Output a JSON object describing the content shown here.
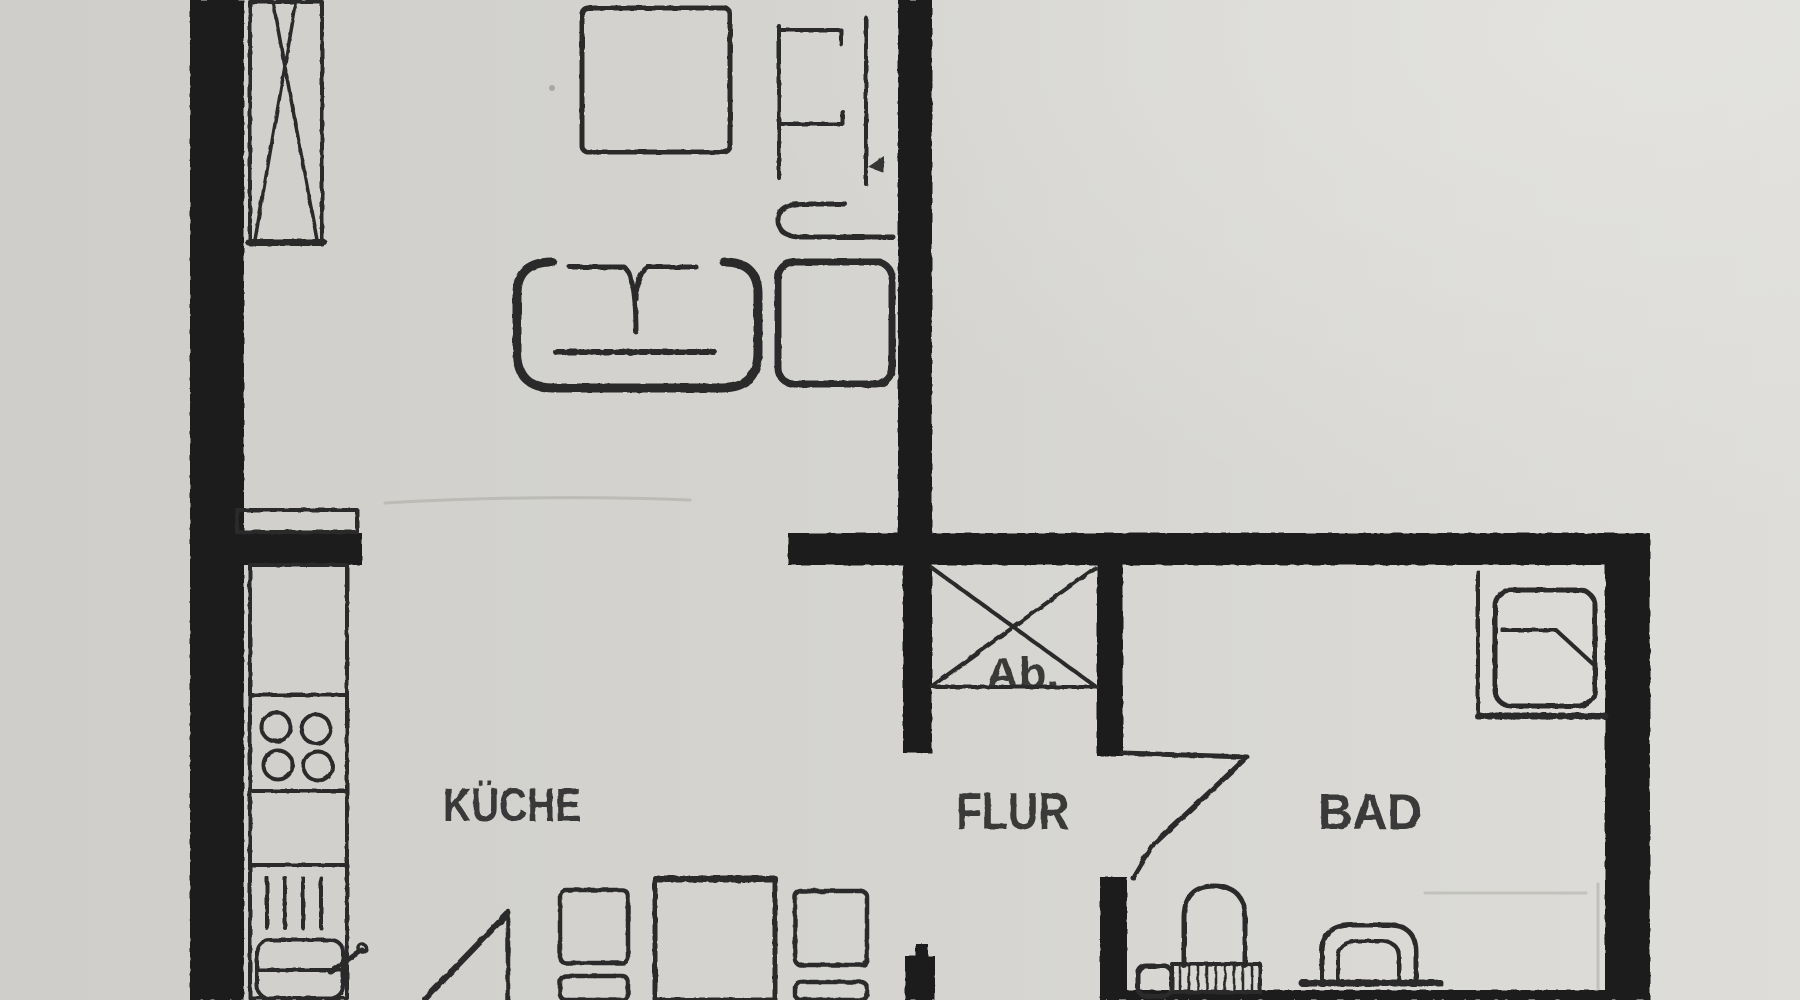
{
  "document": {
    "kind": "scanned apartment floor plan",
    "language": "de"
  },
  "rooms": [
    {
      "id": "kueche",
      "label": "KÜCHE",
      "type": "kitchen"
    },
    {
      "id": "flur",
      "label": "FLUR",
      "type": "hallway"
    },
    {
      "id": "bad",
      "label": "BAD",
      "type": "bathroom"
    },
    {
      "id": "ab",
      "label": "Ab.",
      "type": "storage-closet"
    }
  ],
  "symbols": [
    "wardrobe-x-symbol",
    "square-table",
    "sofa",
    "armchair",
    "side-unit",
    "wall-shelf-unit",
    "storage-x-symbol",
    "kitchen-counter",
    "cooktop-4-burners",
    "drainer-hatching",
    "kitchen-sink",
    "kitchen-table",
    "chairs",
    "door-swing-kitchen",
    "door-swing-bathroom",
    "shower",
    "toilet",
    "toilet-cistern",
    "washbasin"
  ],
  "colors": {
    "paper": "#d4d3cf",
    "paper-light": "#deddda",
    "ink": "#2b2b2b",
    "wall": "#1b1b1b",
    "faint": "#aaa9a4"
  }
}
